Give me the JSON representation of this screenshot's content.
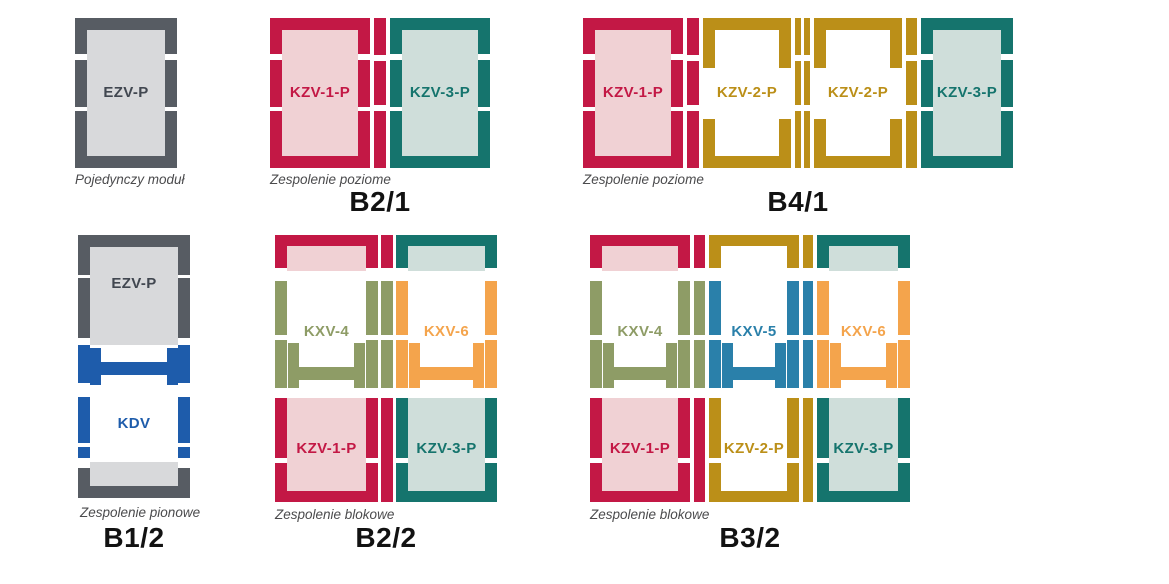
{
  "colors": {
    "red": "#c31845",
    "red_fill": "#f0d1d4",
    "teal": "#15746d",
    "teal_fill": "#cfdeda",
    "gold": "#bb8f18",
    "olive": "#8e9c66",
    "orange": "#f4a44c",
    "blue": "#1e5cab",
    "blue2": "#2a80aa",
    "gray": "#575c63",
    "gray_fill": "#d8d9db",
    "gray_text": "#414750",
    "caption": "#4b4b4d",
    "code": "#121212"
  },
  "diagrams": {
    "single": {
      "module": "EZV-P",
      "caption": "Pojedynczy moduł"
    },
    "b21": {
      "code": "B2/1",
      "caption": "Zespolenie poziome",
      "modules": [
        "KZV-1-P",
        "KZV-3-P"
      ]
    },
    "b41": {
      "code": "B4/1",
      "caption": "Zespolenie poziome",
      "modules": [
        "KZV-1-P",
        "KZV-2-P",
        "KZV-2-P",
        "KZV-3-P"
      ]
    },
    "b12": {
      "code": "B1/2",
      "caption": "Zespolenie pionowe",
      "modules": [
        "EZV-P",
        "KDV"
      ]
    },
    "b22": {
      "code": "B2/2",
      "caption": "Zespolenie blokowe",
      "top": [
        "KXV-4",
        "KXV-6"
      ],
      "bottom": [
        "KZV-1-P",
        "KZV-3-P"
      ]
    },
    "b32": {
      "code": "B3/2",
      "caption": "Zespolenie blokowe",
      "top": [
        "KXV-4",
        "KXV-5",
        "KXV-6"
      ],
      "bottom": [
        "KZV-1-P",
        "KZV-2-P",
        "KZV-3-P"
      ]
    }
  }
}
